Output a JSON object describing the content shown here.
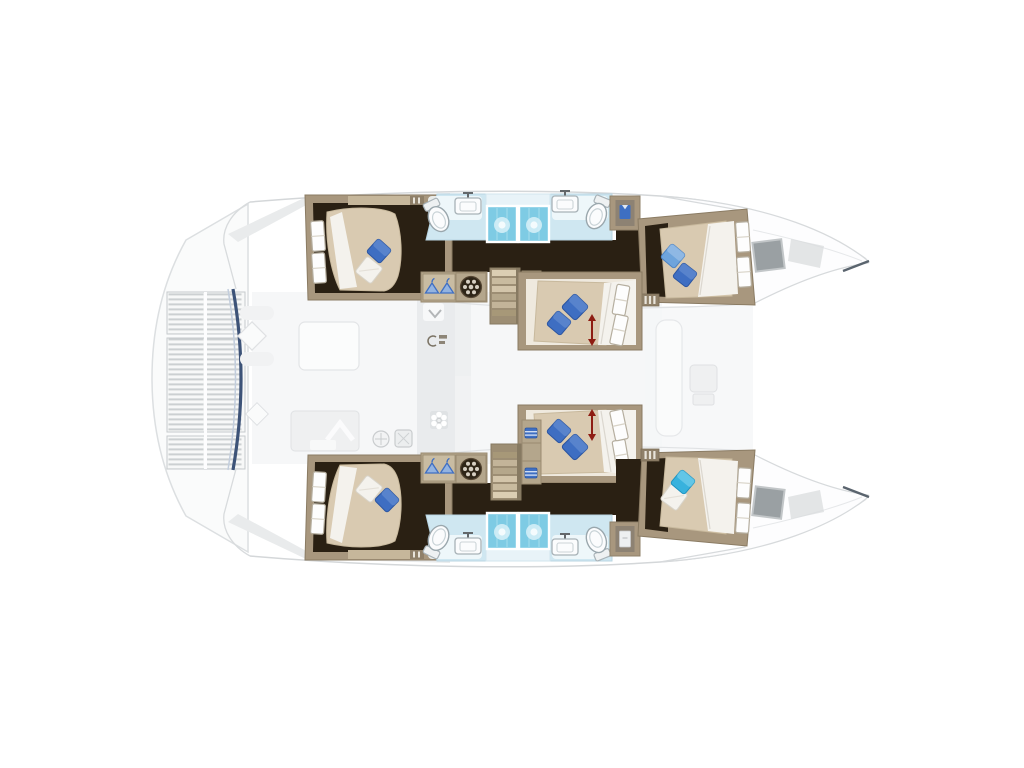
{
  "meta": {
    "description": "Overhead floor plan of a six-cabin sailing catamaran, bows pointing right; saloon deck shown ghosted, hull accommodation in full colour"
  },
  "vessel": {
    "type": "catamaran floor plan",
    "view": "overhead",
    "bow_direction": "right",
    "cabins": [
      {
        "name": "Aft cabin - top hull",
        "bed": "double berth",
        "pillows": "blue + white"
      },
      {
        "name": "Forward cabin - top hull",
        "bed": "double berth",
        "pillows": "light blue + blue"
      },
      {
        "name": "Center cabin - upper nacelle",
        "bed": "double berth",
        "pillows": "two blue",
        "marker": "red sliding-berth arrow"
      },
      {
        "name": "Center cabin - lower nacelle",
        "bed": "double berth",
        "pillows": "two blue",
        "marker": "red sliding-berth arrow"
      },
      {
        "name": "Aft cabin - bottom hull",
        "bed": "double berth",
        "pillows": "white + blue"
      },
      {
        "name": "Forward cabin - bottom hull",
        "bed": "double berth",
        "pillows": "cyan + white"
      }
    ],
    "bathrooms": [
      {
        "name": "Top hull bathroom",
        "fixtures": [
          "toilet",
          "washbasin",
          "twin showers",
          "washbasin",
          "toilet",
          "wardrobe with blue shirt"
        ]
      },
      {
        "name": "Bottom hull bathroom",
        "fixtures": [
          "toilet",
          "washbasin",
          "twin showers",
          "washbasin",
          "toilet",
          "locker with door"
        ]
      }
    ],
    "utilities": [
      "hanging locker x2",
      "washing machine x2",
      "companionway stairs x2",
      "towel shelves x4",
      "striped cabinet x2"
    ],
    "ghosted_deck": [
      "aft platform with slatted floor",
      "aft cockpit seating and diamond tables",
      "saloon table",
      "galley counters with sink and hob icons",
      "companionway chevron mat",
      "forward cockpit bench and table",
      "bow deck hatches"
    ]
  },
  "colors": {
    "background": "#ffffff",
    "ghost_outline": "#d5d8da",
    "wood_frame": "#a8977e",
    "wood_dark": "#8f8069",
    "wood_light": "#c6b79b",
    "floor_dark": "#2a2013",
    "bed_tan": "#d9cab1",
    "linen_white": "#f4f2ed",
    "pillow_blue": "#3e6ec2",
    "pillow_blue_light": "#6ea4dc",
    "pillow_cyan": "#38b2dd",
    "bath_floor": "#cfe7f1",
    "shower_tile": "#7ecbe4",
    "fixture_white": "#fbfcfd",
    "hanger_blue": "#3f6fc3",
    "arrow_red": "#8e1d12",
    "bow_hatch_gray": "#9aa0a3",
    "transom_blue": "#3d5378"
  }
}
